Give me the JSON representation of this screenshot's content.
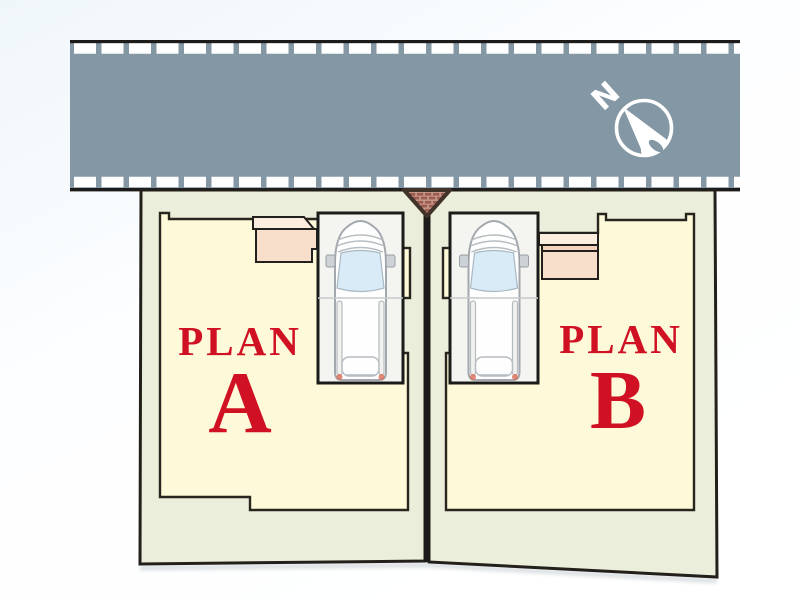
{
  "scene": {
    "type": "residential-site-plan"
  },
  "compass": {
    "north_label": "N"
  },
  "plots": [
    {
      "name": "Plan A",
      "label": "PLAN",
      "letter": "A"
    },
    {
      "name": "Plan B",
      "label": "PLAN",
      "letter": "B"
    }
  ],
  "colors": {
    "road": "#8497a5",
    "road_edge": "#1d1b19",
    "road_tick": "#ffffff",
    "plot": "#eaeeda",
    "footprint": "#fdf9d9",
    "parking": "#f4f4f0",
    "porch_light": "#fceede",
    "porch_mid": "#f3d3be",
    "porch_dark": "#f8dfcb",
    "label": "#d01023",
    "brick": "#9e5a50",
    "mortar": "#c9a28f",
    "compass": "#ffffff"
  }
}
